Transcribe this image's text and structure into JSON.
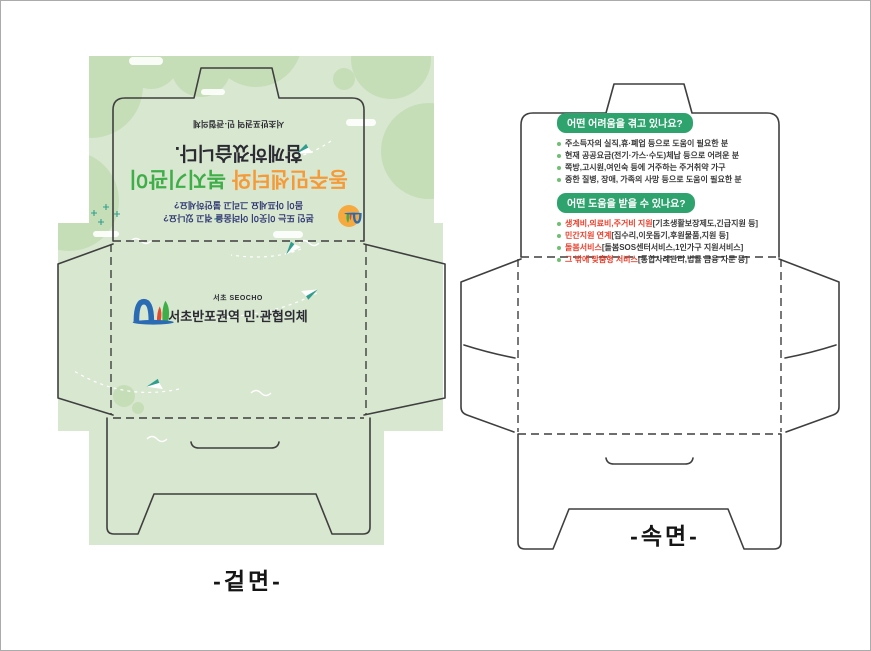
{
  "outer_side": {
    "label": "-겉면-",
    "flap": {
      "question_line1": "본인 또는 이웃이 어려움을 겪고 있나요?",
      "question_line2": "몸이 아프세요 그리고 불안하세요?",
      "title_part_orange": "동주민센터와",
      "title_part_green": "복지기관이",
      "title_line2": "함께하겠습니다.",
      "org_header": "서초반포권역 민·관협의체"
    },
    "body": {
      "logo_caption": "서초 SEOCHO",
      "org_name": "서초반포권역 민·관협의체"
    }
  },
  "inner_side": {
    "label": "-속면-",
    "section1": {
      "badge": "어떤 어려움을 겪고 있나요?",
      "items": [
        "주소득자의 실직,휴·폐업 등으로 도움이 필요한 분",
        "현재 공공요금(전기·가스·수도)체납 등으로 어려운 분",
        "쪽방,고시원,여인숙 등에 거주하는 주거취약 가구",
        "중한 질병, 장애, 가족의 사망 등으로 도움이 필요한 분"
      ]
    },
    "section2": {
      "badge": "어떤 도움을 받을 수 있나요?",
      "items": [
        {
          "head": "생계비,의료비,주거비 지원",
          "tail": "[기초생활보장제도,긴급지원 등]"
        },
        {
          "head": "민간지원 연계",
          "tail": "[집수리,이웃돕기,후원물품,지원 등]"
        },
        {
          "head": "돌봄서비스",
          "tail": "[돌봄SOS센터서비스,1인가구 지원서비스]"
        },
        {
          "head": "그 밖에 맞춤형 서비스",
          "tail": "[통합사례관리,법률 금융 자문 등]"
        }
      ]
    }
  },
  "colors": {
    "accent_orange": "#F59A38",
    "accent_green": "#3FAE49",
    "badge_green": "#2FA36E",
    "alert_red": "#E8402D",
    "bleed_green": "#D8E7CF",
    "blob_green": "#C6DEB8",
    "text_dark": "#2B2B33",
    "text_navy": "#333A75",
    "dieline": "#3F3F3F",
    "sun_orange": "#F5A93F"
  }
}
